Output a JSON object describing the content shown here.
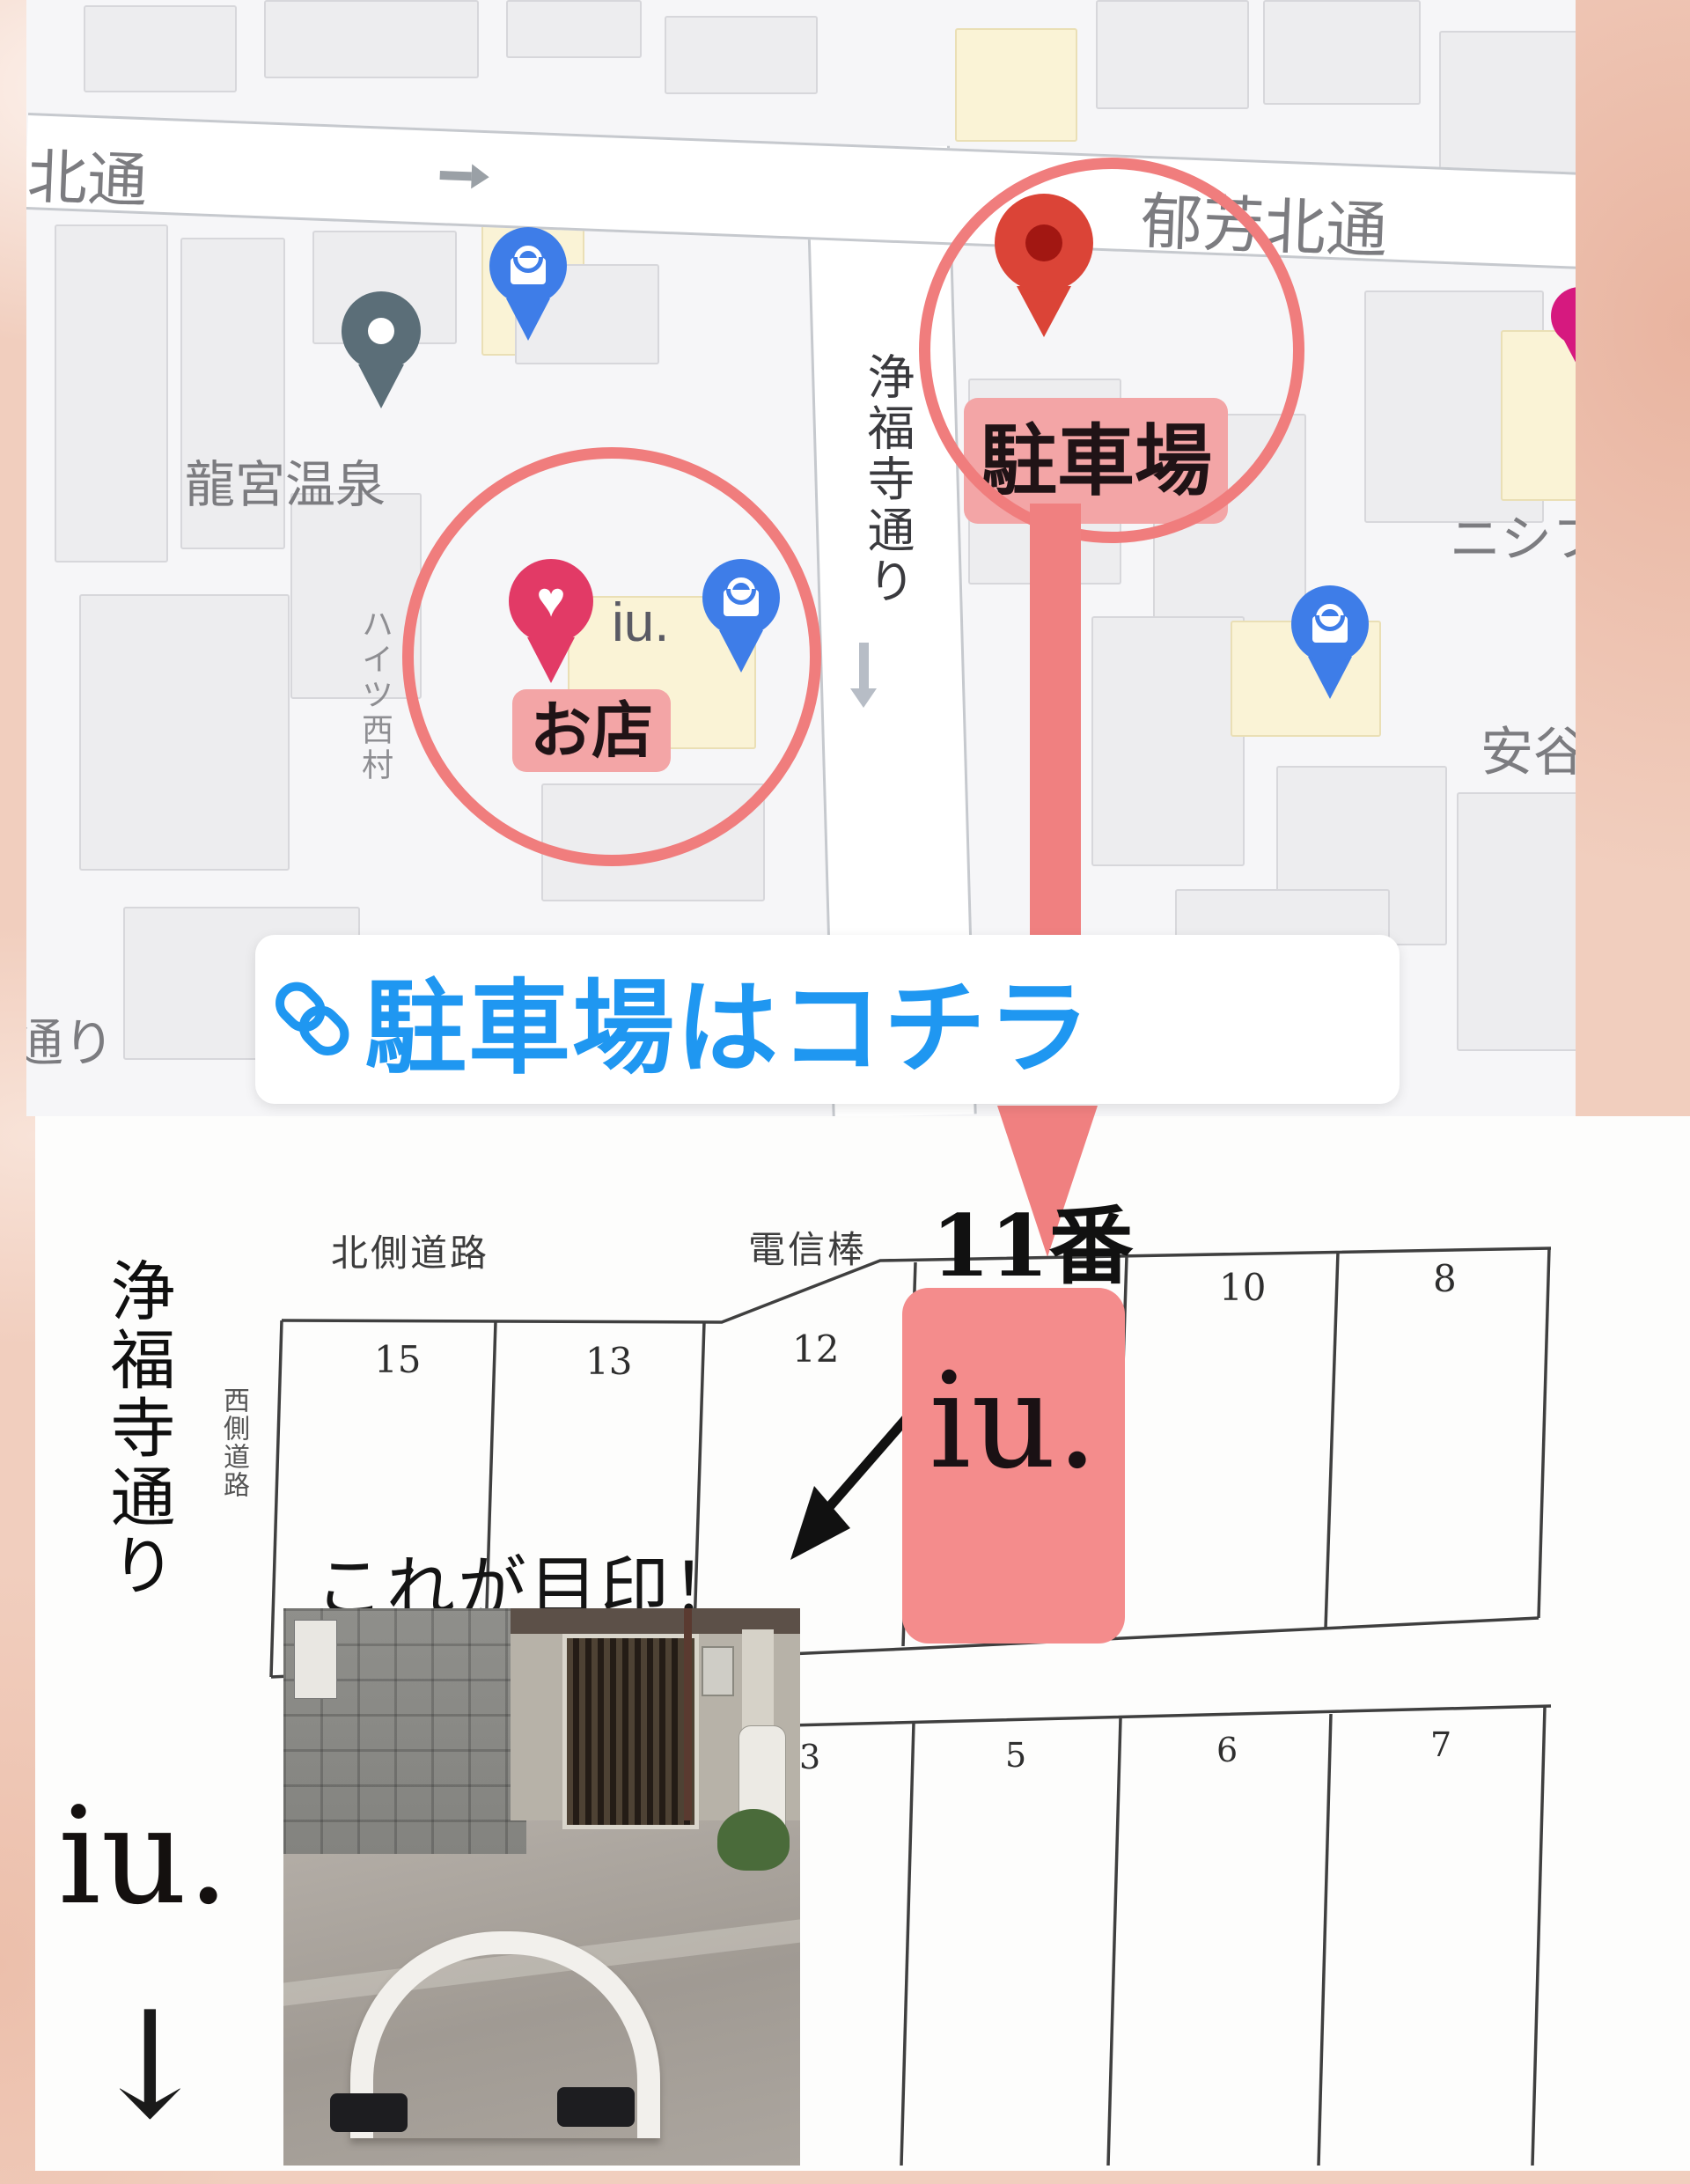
{
  "map": {
    "street_top_partial": "芳北通",
    "street_top_right": "郁芳北通",
    "street_vertical": "浄福寺通り",
    "street_bottom_partial": "通り",
    "poi_onsen": "龍宮温泉",
    "poi_heights": "ハイツ西村",
    "poi_nishifu": "ニシフ",
    "poi_yasutani": "安谷",
    "shop_pin_text": "iu.",
    "shop_badge": "お店",
    "parking_badge": "駐車場"
  },
  "banner": {
    "label": "駐車場はコチラ",
    "icon": "link-icon",
    "color": "#1F97F1"
  },
  "diagram": {
    "label_north_road": "北側道路",
    "label_pole": "電信棒",
    "label_west_road": "西側道路",
    "label_street": "浄福寺通り",
    "spaces_top": [
      "15",
      "13",
      "12",
      "11番",
      "10",
      "8"
    ],
    "spaces_bottom": [
      "3",
      "5",
      "6",
      "7"
    ],
    "highlight": {
      "space": "11番",
      "brand": "iu.",
      "color": "#F48C8C"
    },
    "note": "これが目印！"
  },
  "footer": {
    "brand": "iu.",
    "arrow": "↓"
  },
  "colors": {
    "accent_red": "#F08080",
    "badge_pink": "#F3A5A6",
    "link_blue": "#1F97F1",
    "pin_red": "#DB4437",
    "pin_blue": "#3E7DE8",
    "pin_heart": "#E23A66",
    "pin_gray": "#5B6E78",
    "pin_magenta": "#D6197F",
    "highlight_pink": "#F48C8C"
  }
}
